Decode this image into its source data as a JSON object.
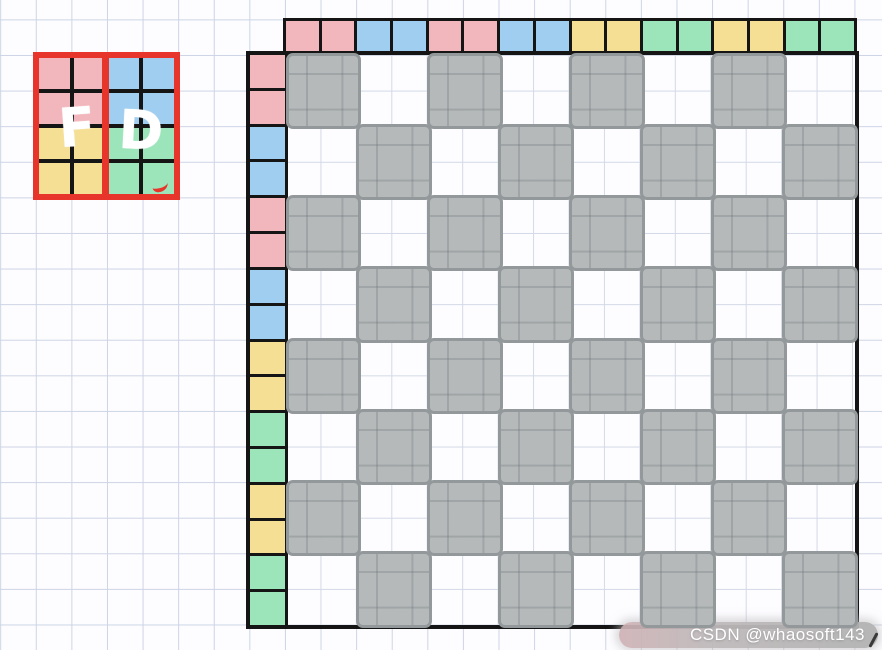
{
  "colors": {
    "pink": "#f2b7bc",
    "blue": "#a0cef0",
    "yellow": "#f4df95",
    "green": "#9ce4ba",
    "gray": "#b5b9ba",
    "gray_border": "#93989a",
    "red": "#e8352c",
    "black": "#151515",
    "paper_line": "#cdd4e5"
  },
  "legend": {
    "left_letter": "F",
    "right_letter": "D",
    "grid": [
      [
        "pink",
        "pink",
        "blue",
        "blue"
      ],
      [
        "pink",
        "pink",
        "blue",
        "blue"
      ],
      [
        "yellow",
        "yellow",
        "green",
        "green"
      ],
      [
        "yellow",
        "yellow",
        "green",
        "green"
      ]
    ]
  },
  "strips": {
    "top": [
      "pink",
      "pink",
      "blue",
      "blue",
      "pink",
      "pink",
      "blue",
      "blue",
      "yellow",
      "yellow",
      "green",
      "green",
      "yellow",
      "yellow",
      "green",
      "green"
    ],
    "left": [
      "pink",
      "pink",
      "blue",
      "blue",
      "pink",
      "pink",
      "blue",
      "blue",
      "yellow",
      "yellow",
      "green",
      "green",
      "yellow",
      "yellow",
      "green",
      "green"
    ]
  },
  "board": {
    "rows": 8,
    "cols": 8,
    "pattern": "checkerboard",
    "cells": [
      [
        1,
        0,
        1,
        0,
        1,
        0,
        1,
        0
      ],
      [
        0,
        1,
        0,
        1,
        0,
        1,
        0,
        1
      ],
      [
        1,
        0,
        1,
        0,
        1,
        0,
        1,
        0
      ],
      [
        0,
        1,
        0,
        1,
        0,
        1,
        0,
        1
      ],
      [
        1,
        0,
        1,
        0,
        1,
        0,
        1,
        0
      ],
      [
        0,
        1,
        0,
        1,
        0,
        1,
        0,
        1
      ],
      [
        1,
        0,
        1,
        0,
        1,
        0,
        1,
        0
      ],
      [
        0,
        1,
        0,
        1,
        0,
        1,
        0,
        1
      ]
    ]
  },
  "watermark": {
    "text": "CSDN @whaosoft143"
  }
}
